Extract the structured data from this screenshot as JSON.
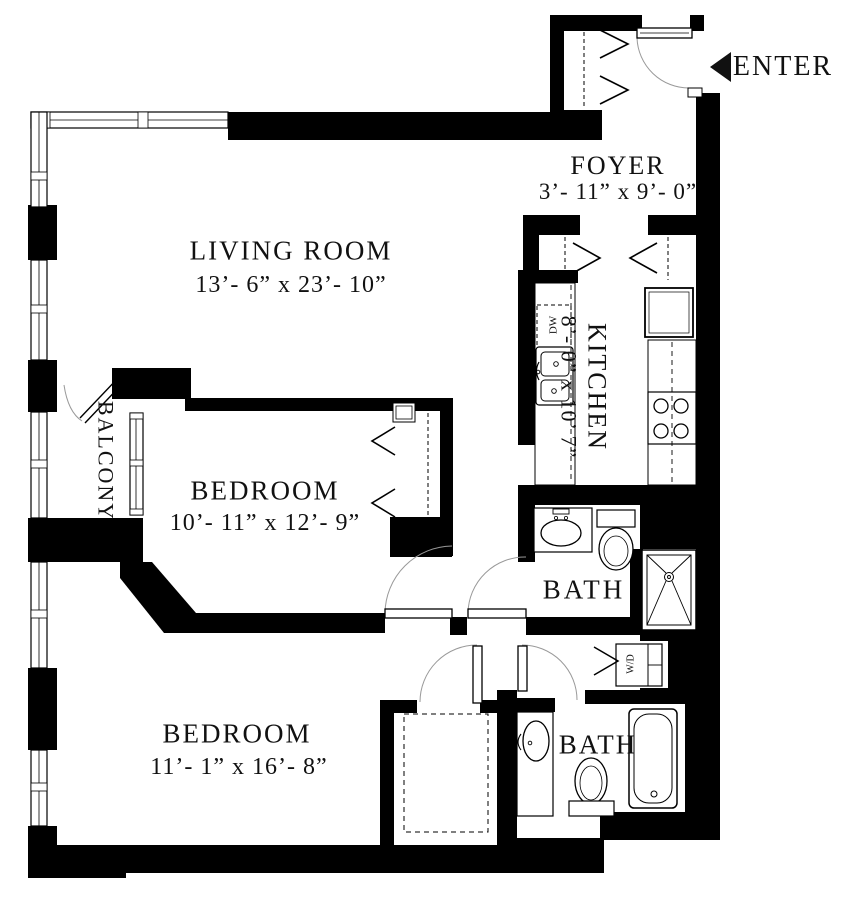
{
  "plan": {
    "rooms": [
      {
        "key": "living-room",
        "label": "LIVING ROOM",
        "dims": "13’- 6” x 23’- 10”"
      },
      {
        "key": "foyer",
        "label": "FOYER",
        "dims": "3’- 11” x 9’- 0”"
      },
      {
        "key": "kitchen",
        "label": "KITCHEN",
        "dims": "8’- 0” x 10’ 7”"
      },
      {
        "key": "balcony",
        "label": "BALCONY",
        "dims": ""
      },
      {
        "key": "bedroom-1",
        "label": "BEDROOM",
        "dims": "10’- 11” x 12’- 9”"
      },
      {
        "key": "bath-1",
        "label": "BATH",
        "dims": ""
      },
      {
        "key": "bedroom-2",
        "label": "BEDROOM",
        "dims": "11’- 1” x 16’- 8”"
      },
      {
        "key": "bath-2",
        "label": "BATH",
        "dims": ""
      }
    ],
    "entry": {
      "label": "ENTER"
    },
    "appliances": {
      "dishwasher": "DW",
      "washer_dryer": "W/D"
    },
    "colors": {
      "wall": "#000000",
      "background": "#ffffff",
      "text": "#111111",
      "door_arc": "#999999"
    }
  }
}
